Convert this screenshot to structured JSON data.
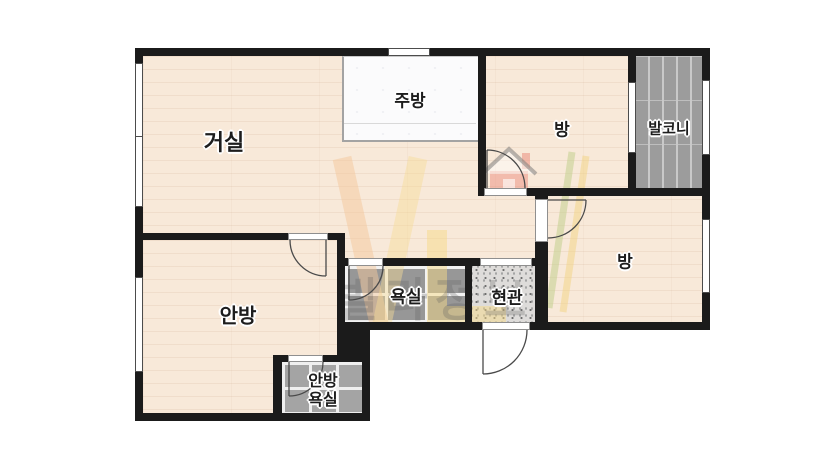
{
  "plan": {
    "type": "apartment-floor-plan",
    "rooms": [
      {
        "id": "living-room",
        "name": "거실"
      },
      {
        "id": "kitchen",
        "name": "주방"
      },
      {
        "id": "bedroom-top",
        "name": "방"
      },
      {
        "id": "balcony",
        "name": "발코니"
      },
      {
        "id": "bedroom-right",
        "name": "방"
      },
      {
        "id": "master-bedroom",
        "name": "안방"
      },
      {
        "id": "bathroom",
        "name": "욕실"
      },
      {
        "id": "entrance",
        "name": "현관"
      },
      {
        "id": "master-bathroom",
        "name": "안방 욕실",
        "line1": "안방",
        "line2": "욕실"
      }
    ],
    "watermark": {
      "logo": "VL",
      "text": "빌라정보"
    },
    "colors": {
      "wall": "#1b1b1b",
      "floor": "#f8e9d9",
      "bath_tile": "#979797",
      "small_bath_tile": "#a4a4a4",
      "balcony_plank": "#9c9c9c",
      "entrance_floor": "#dedcda",
      "kitchen_floor": "#fbfbfc",
      "watermark_orange": "#f3c79b",
      "watermark_yellow": "#f5d988",
      "watermark_green": "#c3cf8e",
      "watermark_house_red": "#e98273"
    }
  }
}
